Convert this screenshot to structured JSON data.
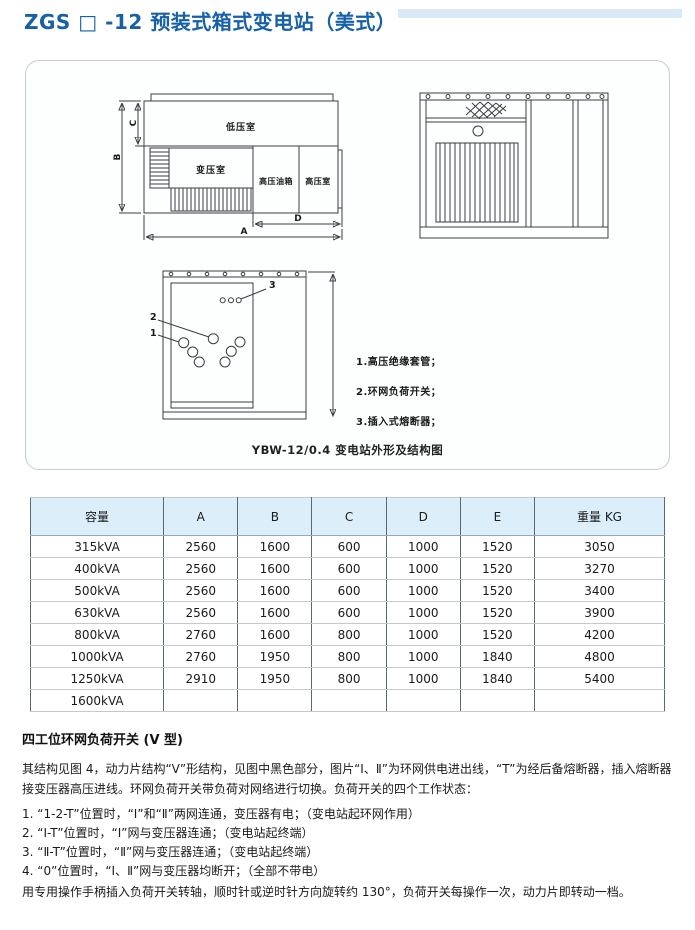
{
  "page": {
    "title": "ZGS □ -12 预装式箱式变电站（美式）"
  },
  "figure": {
    "caption": "YBW-12/0.4 变电站外形及结构图",
    "plan": {
      "rooms": {
        "low_voltage": "低压室",
        "transformer": "变压室",
        "hv_oil_tank": "高压油箱",
        "hv_room": "高压室"
      },
      "dims": {
        "a": "A",
        "b": "B",
        "c": "C",
        "d": "D"
      }
    },
    "callouts": {
      "n1": "1",
      "n2": "2",
      "n3": "3"
    },
    "legend": [
      "1.高压绝缘套管；",
      "2.环网负荷开关；",
      "3.插入式熔断器；"
    ]
  },
  "table": {
    "headers": [
      "容量",
      "A",
      "B",
      "C",
      "D",
      "E",
      "重量 KG"
    ],
    "rows": [
      [
        "315kVA",
        "2560",
        "1600",
        "600",
        "1000",
        "1520",
        "3050"
      ],
      [
        "400kVA",
        "2560",
        "1600",
        "600",
        "1000",
        "1520",
        "3270"
      ],
      [
        "500kVA",
        "2560",
        "1600",
        "600",
        "1000",
        "1520",
        "3400"
      ],
      [
        "630kVA",
        "2560",
        "1600",
        "600",
        "1000",
        "1520",
        "3900"
      ],
      [
        "800kVA",
        "2760",
        "1600",
        "800",
        "1000",
        "1520",
        "4200"
      ],
      [
        "1000kVA",
        "2760",
        "1950",
        "800",
        "1000",
        "1840",
        "4800"
      ],
      [
        "1250kVA",
        "2910",
        "1950",
        "800",
        "1000",
        "1840",
        "5400"
      ],
      [
        "1600kVA",
        "",
        "",
        "",
        "",
        "",
        ""
      ]
    ]
  },
  "switch_section": {
    "heading": "四工位环网负荷开关 (V 型)",
    "intro": "其结构见图 4，动力片结构“V”形结构，见图中黑色部分，图片“Ⅰ、Ⅱ”为环网供电进出线，“T”为经后备熔断器，插入熔断器接变压器高压进线。环网负荷开关带负荷对网络进行切换。负荷开关的四个工作状态：",
    "items": [
      "1. “1-2-T”位置时，“Ⅰ”和“Ⅱ”两网连通，变压器有电；（变电站起环网作用）",
      "2. “Ⅰ-T”位置时，“Ⅰ”网与变压器连通；（变电站起终端）",
      "3. “Ⅱ-T”位置时，“Ⅱ”网与变压器连通；（变电站起终端）",
      "4. “0”位置时，“Ⅰ、Ⅱ”网与变压器均断开；（全部不带电）"
    ],
    "footer": "用专用操作手柄插入负荷开关转轴，顺时针或逆时针方向旋转约 130°，负荷开关每操作一次，动力片即转动一档。"
  },
  "colors": {
    "title_blue": "#1660a8",
    "accent_bar": "#d8eaf7",
    "table_header_bg": "#dceefa",
    "drawing_line": "#3a3f44"
  }
}
